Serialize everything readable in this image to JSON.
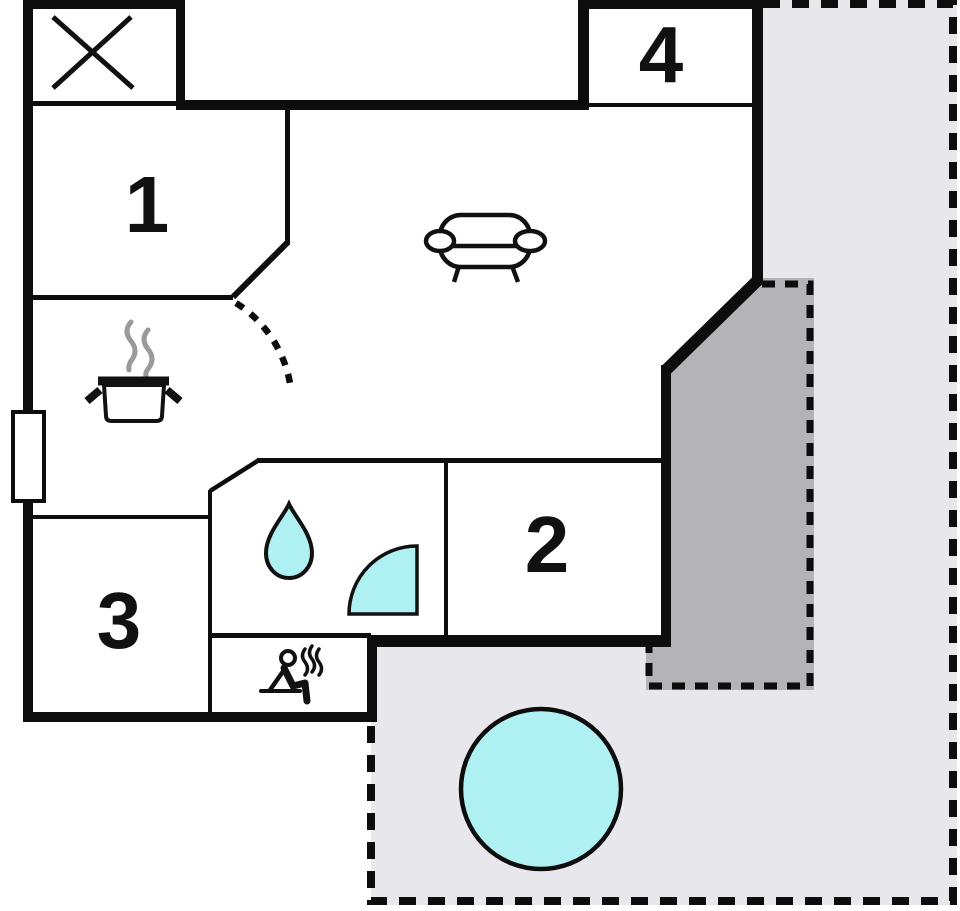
{
  "floorplan": {
    "room_labels": {
      "room1": "1",
      "room2": "2",
      "room3": "3",
      "room4": "4"
    },
    "colors": {
      "wall": "#0d0d0d",
      "water_fill": "#aff1f2",
      "terrace_light": "#e8e7ec",
      "terrace_dark": "#b4b3b7",
      "steam_gray": "#9a9a9a",
      "background": "#ffffff"
    },
    "icons": {
      "crossed_box": "x-marked-area-icon",
      "sofa": "sofa-icon",
      "cooking_pot": "cooking-pot-icon",
      "door_swing": "door-swing-arc",
      "water_drop": "water-drop-icon",
      "shower": "shower-quarter-icon",
      "sauna": "sauna-person-icon",
      "pool": "round-pool",
      "window": "window-symbol"
    }
  }
}
